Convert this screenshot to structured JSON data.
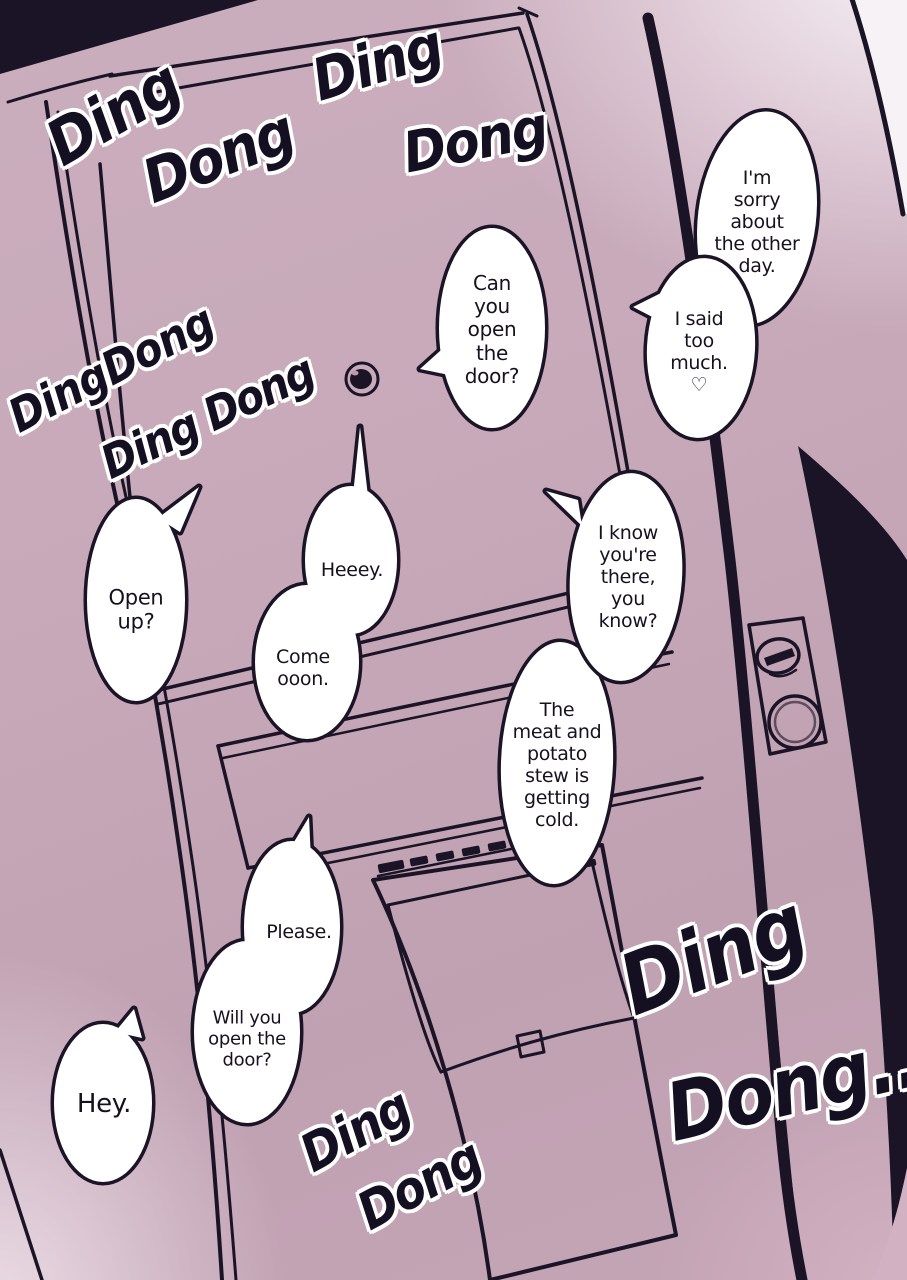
{
  "colors": {
    "door": "#c6a8b8",
    "ink": "#1a1426",
    "corner_light": "#f7f2f5",
    "bubble_fill": "#ffffff",
    "corner_pink": "#d2b2c2"
  },
  "sfx": [
    {
      "id": "sfx-ding-top-left",
      "text": "Ding"
    },
    {
      "id": "sfx-dong-top-left",
      "text": "Dong"
    },
    {
      "id": "sfx-ding-top-mid",
      "text": "Ding"
    },
    {
      "id": "sfx-dong-top-mid",
      "text": "Dong"
    },
    {
      "id": "sfx-dingdong-left",
      "text": "DingDong"
    },
    {
      "id": "sfx-ding-dong-left",
      "text": "Ding Dong"
    },
    {
      "id": "sfx-ding-bottom-right",
      "text": "Ding"
    },
    {
      "id": "sfx-dong-bottom-right",
      "text": "Dong..."
    },
    {
      "id": "sfx-ding-bottom-mid",
      "text": "Ding"
    },
    {
      "id": "sfx-dong-bottom-mid",
      "text": "Dong"
    }
  ],
  "bubbles": [
    {
      "id": "bubble-sorry",
      "text": "I'm\nsorry\nabout\nthe other\nday."
    },
    {
      "id": "bubble-said-too-much",
      "text": "I said\ntoo\nmuch.\n♡"
    },
    {
      "id": "bubble-can-you-open",
      "text": "Can\nyou\nopen\nthe\ndoor?"
    },
    {
      "id": "bubble-open-up",
      "text": "Open\nup?"
    },
    {
      "id": "bubble-heeey",
      "text": "Heeey."
    },
    {
      "id": "bubble-come-ooon",
      "text": "Come\nooon."
    },
    {
      "id": "bubble-i-know",
      "text": "I know\nyou're\nthere,\nyou\nknow?"
    },
    {
      "id": "bubble-stew",
      "text": "The\nmeat and\npotato\nstew is\ngetting\ncold."
    },
    {
      "id": "bubble-please",
      "text": "Please."
    },
    {
      "id": "bubble-will-you-open",
      "text": "Will you\nopen the\ndoor?"
    },
    {
      "id": "bubble-hey",
      "text": "Hey."
    }
  ]
}
